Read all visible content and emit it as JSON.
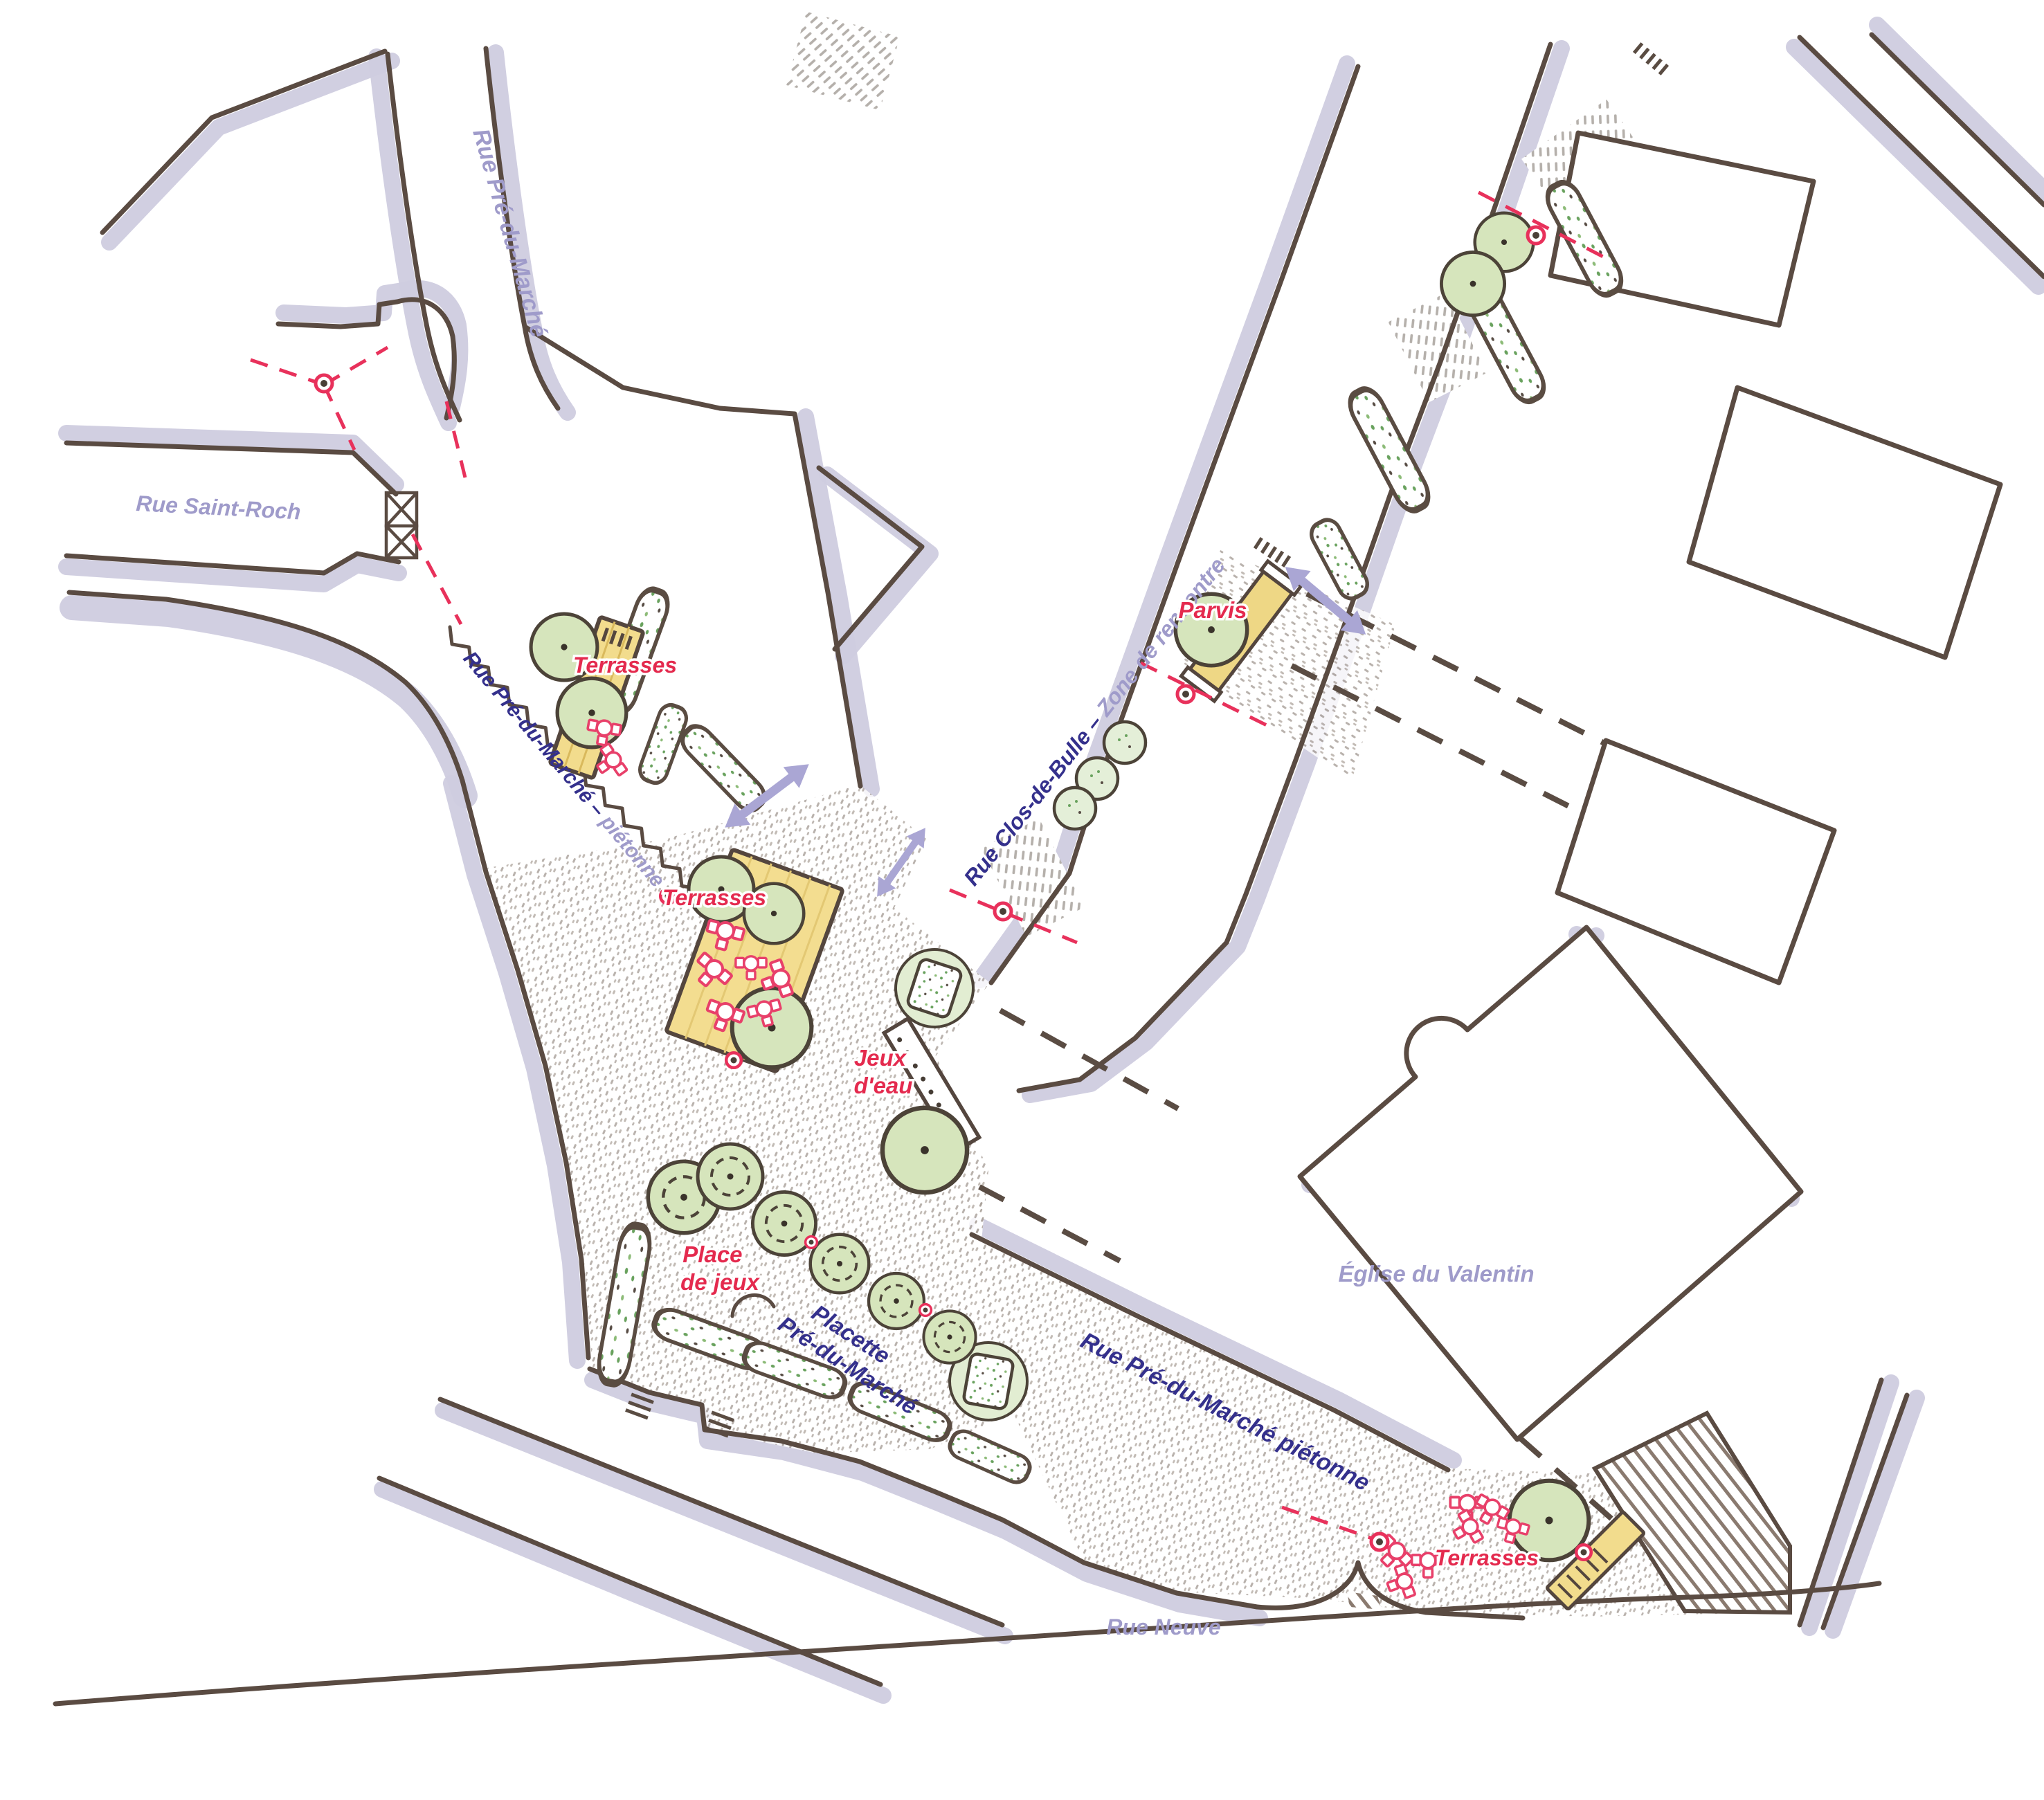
{
  "map": {
    "type": "hand-drawn urban design plan (pedestrianization concept)",
    "labels": {
      "rue_pre_du_marche_top": "Rue Pré-du-Marché",
      "rue_saint_roch": "Rue Saint-Roch",
      "rue_pdm_pietonne_bold": "Rue Pré-du-Marché – ",
      "rue_pdm_pietonne_light": "piétonne",
      "terrasses_upper": "Terrasses",
      "terrasses_center": "Terrasses",
      "terrasses_bottom": "Terrasses",
      "rue_clos_bold": "Rue Clos-de-Bulle – ",
      "rue_clos_light": "Zone de rencontre",
      "parvis": "Parvis",
      "jeux_eau_line1": "Jeux",
      "jeux_eau_line2": "d'eau",
      "place_jeux_line1": "Place",
      "place_jeux_line2": "de jeux",
      "placette_line1": "Placette",
      "placette_line2": "Pré-du-Marché",
      "eglise": "Église du Valentin",
      "rue_pdm_pietonne_lower": "Rue Pré-du-Marché piétonne",
      "rue_neuve": "Rue Neuve"
    },
    "palette": {
      "street_name_lavender": "#9f9bca",
      "pedestrian_zone_blue": "#34308c",
      "program_red": "#e42a4e",
      "red_dashed_limit": "#e8315b",
      "building_outline_brown": "#5a4b42",
      "shadow_lavender": "#cfccdf",
      "tree_green_fill": "#d6e5bc",
      "terrace_deck_yellow": "#f2dc8d",
      "plaza_stipple_gray": "#a89f98",
      "arrow_lavender": "#aaa6d4"
    }
  }
}
